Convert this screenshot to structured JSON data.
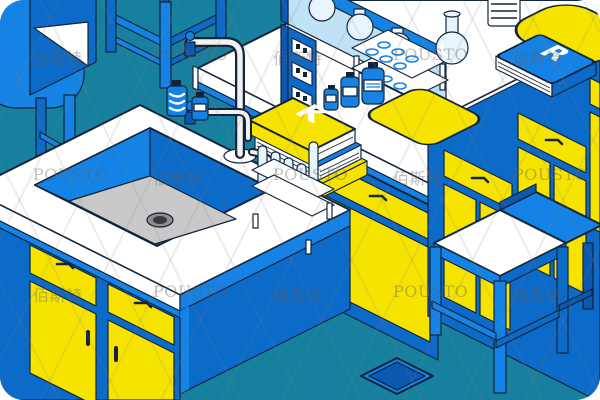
{
  "illustration": {
    "type": "isometric-laboratory-illustration",
    "description": "Blue and yellow isometric lab room with sink island, reagent bottles, glassware shelf, cabinets, stool and chairs"
  },
  "palette": {
    "floor": "#17809f",
    "blue_bright": "#1583e6",
    "blue_mid": "#0c6ac8",
    "blue_deep": "#0a58b0",
    "outline": "#13243a",
    "yellow": "#f6e400",
    "white": "#ffffff",
    "sink_gray": "#c9c9c9",
    "drain_dark": "#3a3a3a",
    "glass": "#bfe2f7",
    "glass_light": "#e9f5fd",
    "watermark": "rgba(95,95,95,0.40)"
  },
  "labels": {
    "yellow_book_letter": "K",
    "blue_book_letter": "R"
  },
  "watermark": {
    "latin": "POUSTO",
    "cjk": "佰斯特",
    "rows": [
      45,
      165,
      282
    ],
    "cols": [
      33,
      153,
      273,
      393,
      513
    ]
  },
  "objects": [
    "corner-armchair",
    "back-chair",
    "lab-stool",
    "back-counter",
    "glass-display-cabinet",
    "power-outlet-pillar",
    "test-tube-rack-empty",
    "reagent-bottles",
    "book-stack",
    "yellow-lab-mat",
    "coil-beaker",
    "round-bottom-flask",
    "blue-book",
    "corner-yellow-mat",
    "right-wall-cabinets",
    "sink-island",
    "lab-sink",
    "gooseneck-faucet",
    "wash-bottles",
    "test-tube-rack-filled",
    "island-cabinets",
    "floor-drain",
    "lab-chair"
  ]
}
